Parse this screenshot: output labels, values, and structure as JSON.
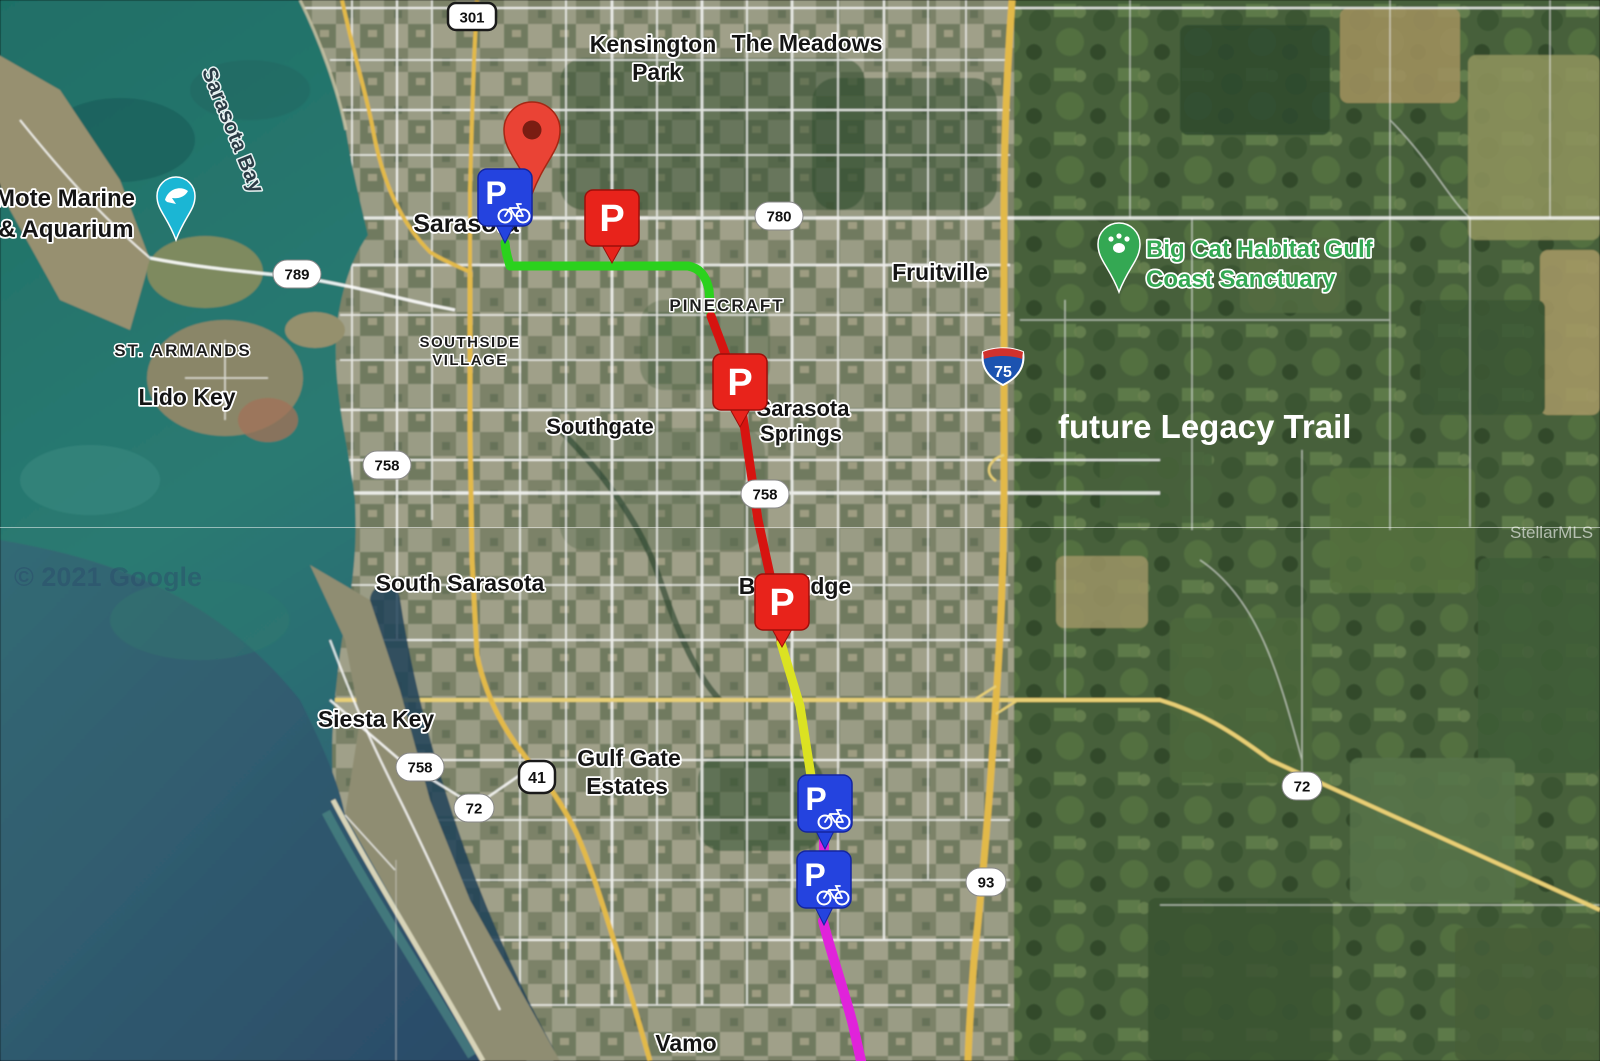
{
  "map": {
    "attribution": "© 2021 Google",
    "mls_watermark": "StellarMLS",
    "annotations": {
      "future_trail": "future Legacy Trail"
    },
    "marker_letter": "P",
    "icons": {
      "bike_parking_marker": "bicycle-icon",
      "trailhead_parking_marker": "parking-icon",
      "destination_marker": "map-pin-icon",
      "big_cat_poi": "paw-icon",
      "mote_marine_poi": "dolphin-icon"
    },
    "colors": {
      "route_green": "#2bd11d",
      "route_red": "#d61410",
      "route_yellow": "#dbe222",
      "route_magenta": "#e023da",
      "bike_parking_blue": "#2443df",
      "parking_red": "#e8231b",
      "destination_pin_red": "#ea4335",
      "poi_green": "#34a853",
      "poi_teal": "#1bb6d4",
      "highway_yellow": "#e2b94a"
    },
    "place_labels": {
      "kensington_park_line1": "Kensington",
      "kensington_park_line2": "Park",
      "the_meadows": "The Meadows",
      "sarasota": "Sarasota",
      "pinecraft": "PINECRAFT",
      "fruitville": "Fruitville",
      "southside_village_line1": "SOUTHSIDE",
      "southside_village_line2": "VILLAGE",
      "southgate": "Southgate",
      "sarasota_springs_line1": "Sarasota",
      "sarasota_springs_line2": "Springs",
      "south_sarasota": "South Sarasota",
      "bee_ridge": "Bee Ridge",
      "siesta_key": "Siesta Key",
      "gulf_gate_estates_line1": "Gulf Gate",
      "gulf_gate_estates_line2": "Estates",
      "vamo": "Vamo",
      "st_armands": "ST. ARMANDS",
      "lido_key": "Lido Key",
      "sarasota_bay": "Sarasota Bay",
      "mote_marine_line1": "Mote Marine",
      "mote_marine_line2": "& Aquarium",
      "big_cat_line1": "Big Cat Habitat Gulf",
      "big_cat_line2": "Coast Sanctuary"
    },
    "road_shields": {
      "us301": "301",
      "sr780": "780",
      "sr789": "789",
      "sr758": "758",
      "us41": "41",
      "sr72": "72",
      "sr93": "93",
      "i75": "75"
    }
  }
}
